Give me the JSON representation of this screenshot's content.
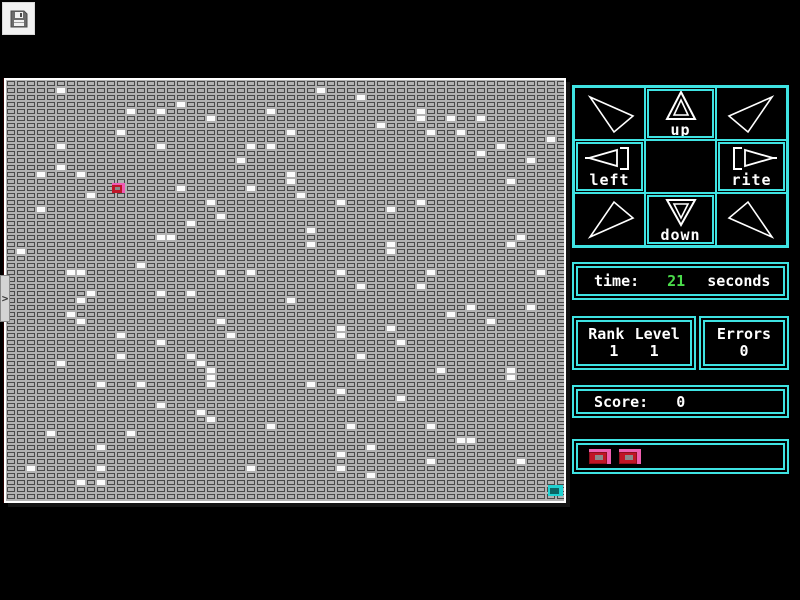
{
  "toolbar": {
    "save_icon": "floppy-disk"
  },
  "side_tab": {
    "label": ">"
  },
  "dpad": {
    "up_label": "up",
    "left_label": "left",
    "rite_label": "rite",
    "down_label": "down",
    "corner_icons": [
      "arrow-nw",
      "arrow-ne",
      "arrow-sw",
      "arrow-se"
    ]
  },
  "stats": {
    "time_label": "time:",
    "time_value": "21",
    "time_unit": "seconds",
    "rank_label": "Rank",
    "level_label": "Level",
    "rank_value": "1",
    "level_value": "1",
    "errors_label": "Errors",
    "errors_value": "0",
    "score_label": "Score:",
    "score_value": "0",
    "lives_count": 2
  },
  "colors": {
    "accent_cyan": "#3fe3e3",
    "time_green": "#4bdc4b",
    "tile_gray": "#b2b2b2",
    "tile_line": "#4a4a4a",
    "player_red": "#c01525",
    "player_pink": "#ef5fb0",
    "goal_cyan": "#1fd2d2"
  },
  "grid": {
    "cols": 56,
    "rows": 60,
    "cell_w": 10,
    "cell_h": 7,
    "player": {
      "col": 10.5,
      "row": 14.6,
      "w": 13,
      "h": 10
    },
    "goal": {
      "col": 54.1,
      "row": 57.7,
      "w": 15,
      "h": 11
    },
    "white_tiles": [
      [
        5,
        1
      ],
      [
        12,
        4
      ],
      [
        15,
        4
      ],
      [
        17,
        3
      ],
      [
        20,
        5
      ],
      [
        26,
        4
      ],
      [
        11,
        7
      ],
      [
        5,
        9
      ],
      [
        15,
        9
      ],
      [
        24,
        9
      ],
      [
        26,
        9
      ],
      [
        23,
        11
      ],
      [
        5,
        12
      ],
      [
        3,
        13
      ],
      [
        7,
        13
      ],
      [
        28,
        13
      ],
      [
        28,
        14
      ],
      [
        17,
        15
      ],
      [
        24,
        15
      ],
      [
        8,
        16
      ],
      [
        20,
        17
      ],
      [
        3,
        18
      ],
      [
        21,
        19
      ],
      [
        18,
        20
      ],
      [
        15,
        22
      ],
      [
        16,
        22
      ],
      [
        1,
        24
      ],
      [
        13,
        26
      ],
      [
        6,
        27
      ],
      [
        7,
        27
      ],
      [
        21,
        27
      ],
      [
        24,
        27
      ],
      [
        31,
        1
      ],
      [
        35,
        2
      ],
      [
        41,
        4
      ],
      [
        41,
        5
      ],
      [
        44,
        5
      ],
      [
        47,
        5
      ],
      [
        37,
        6
      ],
      [
        42,
        7
      ],
      [
        45,
        7
      ],
      [
        28,
        7
      ],
      [
        54,
        8
      ],
      [
        49,
        9
      ],
      [
        47,
        10
      ],
      [
        52,
        11
      ],
      [
        50,
        14
      ],
      [
        29,
        16
      ],
      [
        33,
        17
      ],
      [
        41,
        17
      ],
      [
        38,
        18
      ],
      [
        30,
        21
      ],
      [
        51,
        22
      ],
      [
        30,
        23
      ],
      [
        38,
        23
      ],
      [
        38,
        24
      ],
      [
        50,
        23
      ],
      [
        33,
        27
      ],
      [
        42,
        27
      ],
      [
        53,
        27
      ],
      [
        35,
        29
      ],
      [
        8,
        30
      ],
      [
        15,
        30
      ],
      [
        18,
        30
      ],
      [
        7,
        31
      ],
      [
        28,
        31
      ],
      [
        6,
        33
      ],
      [
        7,
        34
      ],
      [
        21,
        34
      ],
      [
        11,
        36
      ],
      [
        22,
        36
      ],
      [
        15,
        37
      ],
      [
        11,
        39
      ],
      [
        18,
        39
      ],
      [
        19,
        40
      ],
      [
        5,
        40
      ],
      [
        20,
        41
      ],
      [
        20,
        42
      ],
      [
        9,
        43
      ],
      [
        13,
        43
      ],
      [
        20,
        43
      ],
      [
        15,
        46
      ],
      [
        19,
        47
      ],
      [
        20,
        48
      ],
      [
        26,
        49
      ],
      [
        4,
        50
      ],
      [
        12,
        50
      ],
      [
        9,
        52
      ],
      [
        2,
        55
      ],
      [
        9,
        55
      ],
      [
        24,
        55
      ],
      [
        7,
        57
      ],
      [
        9,
        57
      ],
      [
        41,
        29
      ],
      [
        46,
        32
      ],
      [
        52,
        32
      ],
      [
        44,
        33
      ],
      [
        48,
        34
      ],
      [
        33,
        35
      ],
      [
        38,
        35
      ],
      [
        33,
        36
      ],
      [
        39,
        37
      ],
      [
        35,
        39
      ],
      [
        43,
        41
      ],
      [
        50,
        41
      ],
      [
        50,
        42
      ],
      [
        30,
        43
      ],
      [
        33,
        44
      ],
      [
        39,
        45
      ],
      [
        34,
        49
      ],
      [
        42,
        49
      ],
      [
        45,
        51
      ],
      [
        46,
        51
      ],
      [
        36,
        52
      ],
      [
        33,
        53
      ],
      [
        42,
        54
      ],
      [
        51,
        54
      ],
      [
        33,
        55
      ],
      [
        36,
        56
      ]
    ]
  }
}
